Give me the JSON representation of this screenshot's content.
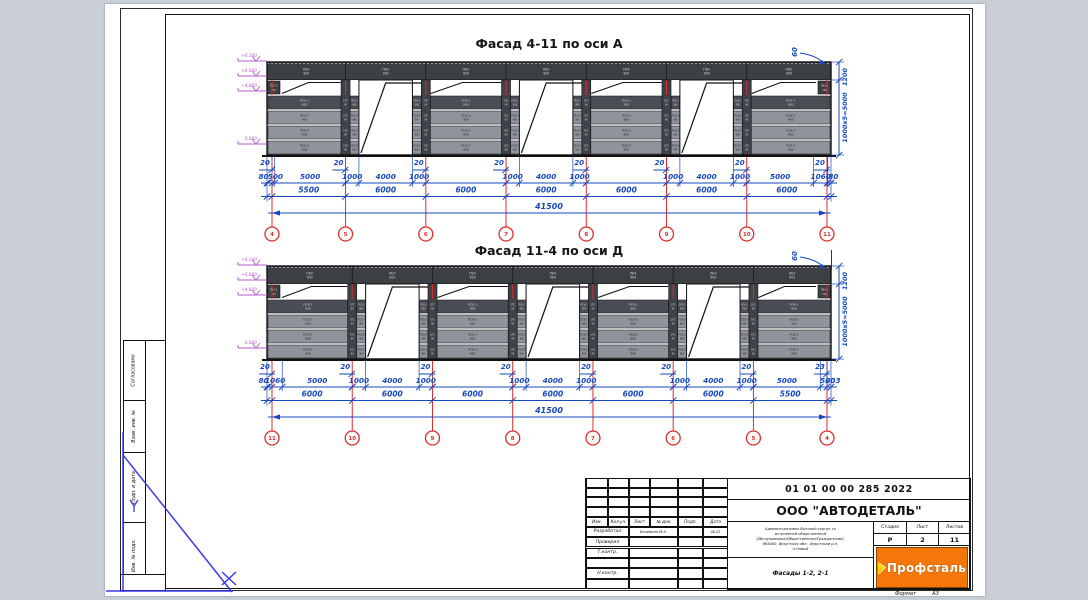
{
  "page": {
    "background": "#c9ced7",
    "sheet": "#ffffff"
  },
  "colors": {
    "dim_blue": "#1748bd",
    "axis_red": "#e02b2b",
    "elevation_magenta": "#b85ccc",
    "fascia_dark": "#3c3f44",
    "panel_mid": "#4a4d53",
    "panel_light": "#8f939b",
    "strip_dark": "#3f4248",
    "logo_orange": "#f5770a",
    "mark_blue": "#3a3af0"
  },
  "facades": [
    {
      "title": "Фасад 4-11 по оси А",
      "axes": [
        "4",
        "5",
        "6",
        "7",
        "8",
        "9",
        "10",
        "11"
      ],
      "bays_mm": [
        5500,
        6000,
        6000,
        6000,
        6000,
        6000,
        6000
      ],
      "detail_dims": [
        [
          "80",
          "500",
          "5000"
        ],
        [
          "1000",
          "4000",
          "1000"
        ],
        [],
        [
          "1000",
          "4000",
          "1000"
        ],
        [],
        [
          "1000",
          "4000",
          "1000"
        ],
        [
          "5000",
          "1060",
          "80"
        ]
      ],
      "bay_dims": [
        "5500",
        "6000",
        "6000",
        "6000",
        "6000",
        "6000",
        "6000"
      ],
      "total_dim": "41500",
      "edge_dims": [
        "20",
        "20",
        "20",
        "20",
        "20",
        "20",
        "20",
        "20"
      ],
      "right_dims": {
        "corner": "60",
        "fascia": "1200",
        "panels": "1000х5=5000"
      },
      "elevations": [
        "+6,160",
        "+6,000",
        "+4,800",
        "0,000"
      ],
      "panel_marks": {
        "fascia": [
          "ПБ5",
          "900"
        ],
        "row0": [
          "ПС6-1",
          "900"
        ],
        "row": [
          "ПС6-2",
          "900"
        ],
        "strip": [
          "1ПС",
          "90"
        ],
        "edge": [
          "ПБ2-3",
          "740"
        ]
      }
    },
    {
      "title": "Фасад 11-4 по оси Д",
      "axes": [
        "11",
        "10",
        "9",
        "8",
        "7",
        "6",
        "5",
        "4"
      ],
      "bays_mm": [
        6000,
        6000,
        6000,
        6000,
        6000,
        6000,
        5500
      ],
      "detail_dims": [
        [
          "80",
          "1060",
          "5000"
        ],
        [
          "1000",
          "4000",
          "1000"
        ],
        [],
        [
          "1000",
          "4000",
          "1000"
        ],
        [],
        [
          "1000",
          "4000",
          "1000"
        ],
        [
          "5000",
          "500",
          "203"
        ]
      ],
      "bay_dims": [
        "6000",
        "6000",
        "6000",
        "6000",
        "6000",
        "6000",
        "5500"
      ],
      "total_dim": "41500",
      "edge_dims": [
        "20",
        "20",
        "20",
        "20",
        "20",
        "20",
        "20",
        "23"
      ],
      "right_dims": {
        "corner": "60",
        "fascia": "1200",
        "panels": "1000х5=5000"
      },
      "elevations": [
        "+6,160",
        "+6,000",
        "+4,800",
        "0,000"
      ],
      "panel_marks": {
        "fascia": [
          "ПБ5",
          "900"
        ],
        "row0": [
          "ПС6-1",
          "900"
        ],
        "row": [
          "ПС6-2",
          "900"
        ],
        "strip": [
          "1ПС",
          "90"
        ],
        "edge": [
          "ПБ2-3",
          "740"
        ]
      }
    }
  ],
  "title_block": {
    "doc_number": "01 01 00 00 285 2022",
    "company": "ООО \"АВТОДЕТАЛЬ\"",
    "description_lines": [
      "Административно-бытовой корпус со",
      "встроенной общественной",
      "/Обслуживание/Общественные/Гражданские/,",
      "664000, Иркутская обл., Иркутский р-н,",
      "п.Новый"
    ],
    "drawing_name": "Фасады 1-2, 2-1",
    "stage_header": "Стадия",
    "sheet_header": "Лист",
    "sheets_header": "Листов",
    "stage": "Р",
    "sheet": "2",
    "sheets": "11",
    "logo_text": "Профсталь",
    "columns": [
      "Изм.",
      "Кол.уч.",
      "Лист",
      "№ док.",
      "Подп.",
      "Дата"
    ],
    "signature_rows": [
      {
        "role": "Разработал",
        "name": "Бечевина М.А.",
        "date": "08.22"
      },
      {
        "role": "Проверил",
        "name": "",
        "date": ""
      },
      {
        "role": "Т.контр.",
        "name": "",
        "date": ""
      },
      {
        "role": "",
        "name": "",
        "date": ""
      },
      {
        "role": "Н.контр.",
        "name": "",
        "date": ""
      },
      {
        "role": "",
        "name": "",
        "date": ""
      }
    ]
  },
  "side_stamp": {
    "labels": [
      "Согласовано",
      "Взам. инв. №",
      "Подп. и дата",
      "Инв. № подл."
    ]
  },
  "format_note": {
    "label": "Формат",
    "value": "А3"
  }
}
